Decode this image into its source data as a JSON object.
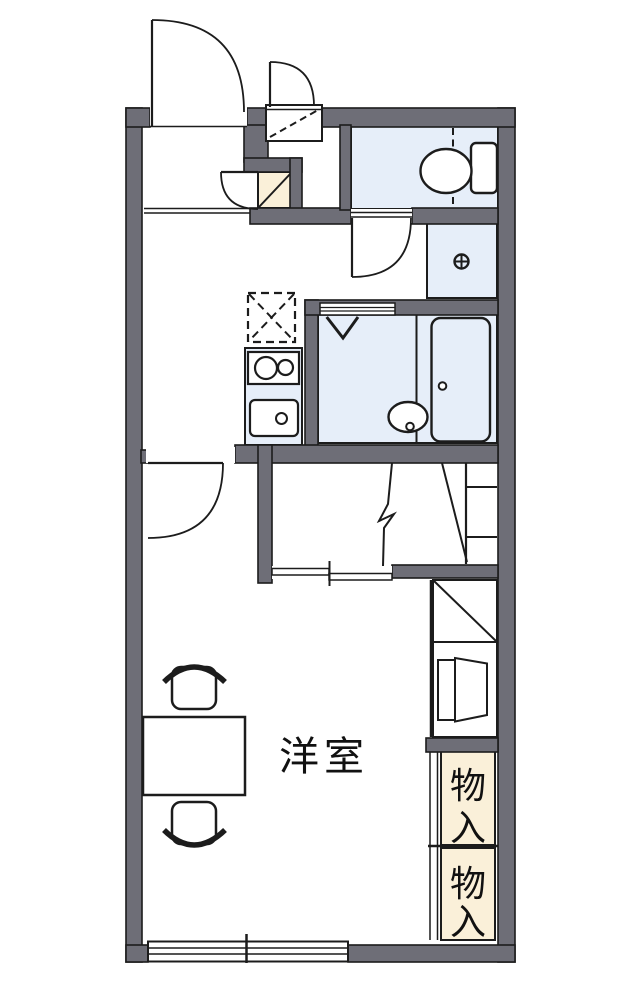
{
  "title": "apartment-floor-plan",
  "colors": {
    "wall": "#6e6e77",
    "outline": "#1c1c1c",
    "water_area_fill": "#e6eef9",
    "storage_fill": "#faf0d9",
    "background": "#ffffff"
  },
  "labels": {
    "main_room": "洋室",
    "storage_upper": [
      "物",
      "入"
    ],
    "storage_lower": [
      "物",
      "入"
    ]
  },
  "fixtures": [
    "entrance-door",
    "entry-hatch-door",
    "shoe-cabinet",
    "toilet",
    "washing-machine-pan",
    "refrigerator-space",
    "gas-stove",
    "kitchen-sink",
    "bathroom-folding-door-mark",
    "bathtub",
    "wash-basin",
    "loft-stairs",
    "water-heater",
    "storage-cabinet",
    "sliding-door",
    "sliding-window",
    "table",
    "chair-top",
    "chair-bottom"
  ]
}
